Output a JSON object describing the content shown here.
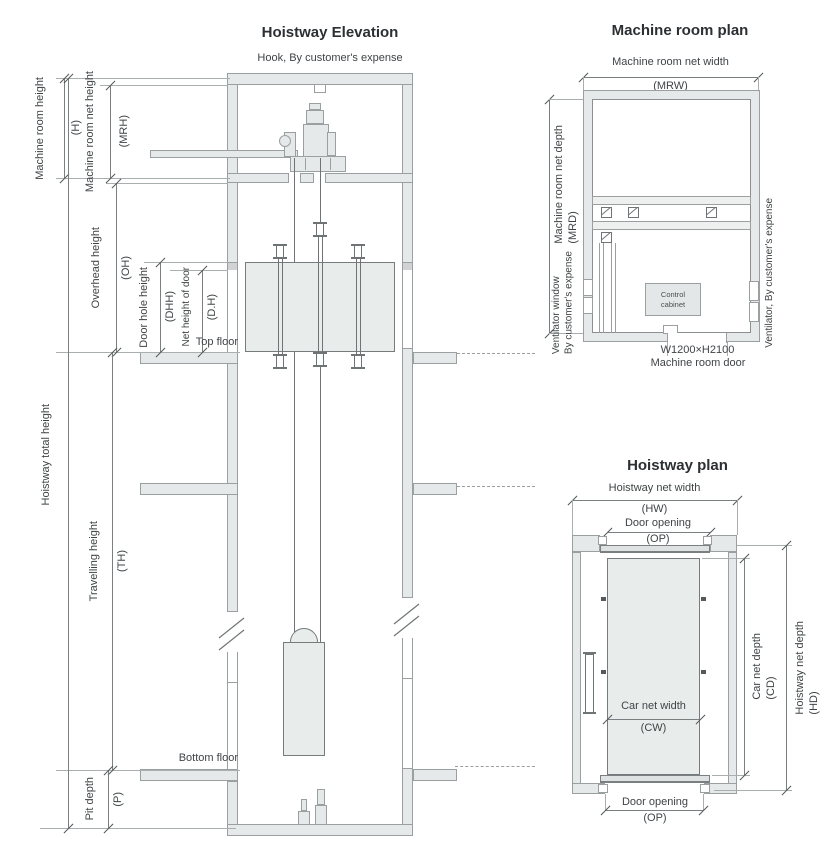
{
  "elevation": {
    "title": "Hoistway Elevation",
    "hook_note": "Hook, By customer's expense",
    "floors": {
      "top": "Top floor",
      "bottom": "Bottom floor"
    },
    "dims": {
      "h": {
        "label": "Machine room height",
        "abbr": "(H)"
      },
      "mrh": {
        "label": "Machine room net height",
        "abbr": "(MRH)"
      },
      "oh": {
        "label": "Overhead height",
        "abbr": "(OH)"
      },
      "dhh": {
        "label": "Door hole height",
        "abbr": "(DHH)"
      },
      "dh": {
        "label": "Net height of door",
        "abbr": "(D.H)"
      },
      "hth": {
        "label": "Hoistway total height",
        "abbr": ""
      },
      "th": {
        "label": "Travelling height",
        "abbr": "(TH)"
      },
      "p": {
        "label": "Pit depth",
        "abbr": "(P)"
      }
    }
  },
  "machine_room_plan": {
    "title": "Machine room plan",
    "dims": {
      "mrw": {
        "label": "Machine room net width",
        "abbr": "(MRW)"
      },
      "mrd": {
        "label": "Machine room net depth",
        "abbr": "(MRD)"
      }
    },
    "notes": {
      "ventilator_window": [
        "Ventilator window",
        "By customer's expense"
      ],
      "ventilator_right": "Ventilator, By customer's expense",
      "control_cabinet": [
        "Control",
        "cabinet"
      ],
      "door_size": "W1200×H2100",
      "door_label": "Machine room door"
    }
  },
  "hoistway_plan": {
    "title": "Hoistway plan",
    "dims": {
      "hw": {
        "label": "Hoistway net width",
        "abbr": "(HW)"
      },
      "op_top": {
        "label": "Door opening",
        "abbr": "(OP)"
      },
      "hd": {
        "label": "Hoistway net depth",
        "abbr": "(HD)"
      },
      "cd": {
        "label": "Car net depth",
        "abbr": "(CD)"
      },
      "cw": {
        "label": "Car net width",
        "abbr": "(CW)"
      },
      "op_bottom": {
        "label": "Door opening",
        "abbr": "(OP)"
      }
    }
  },
  "colors": {
    "background": "#ffffff",
    "wall_fill": "#e6e9e9",
    "wall_line": "#9aa0a0",
    "line": "#6f7476",
    "car_fill": "#e8edec",
    "dim_line": "#7a8082",
    "ext_line": "#a9aeae",
    "text": "#3f4446",
    "title_text": "#2c3032"
  }
}
